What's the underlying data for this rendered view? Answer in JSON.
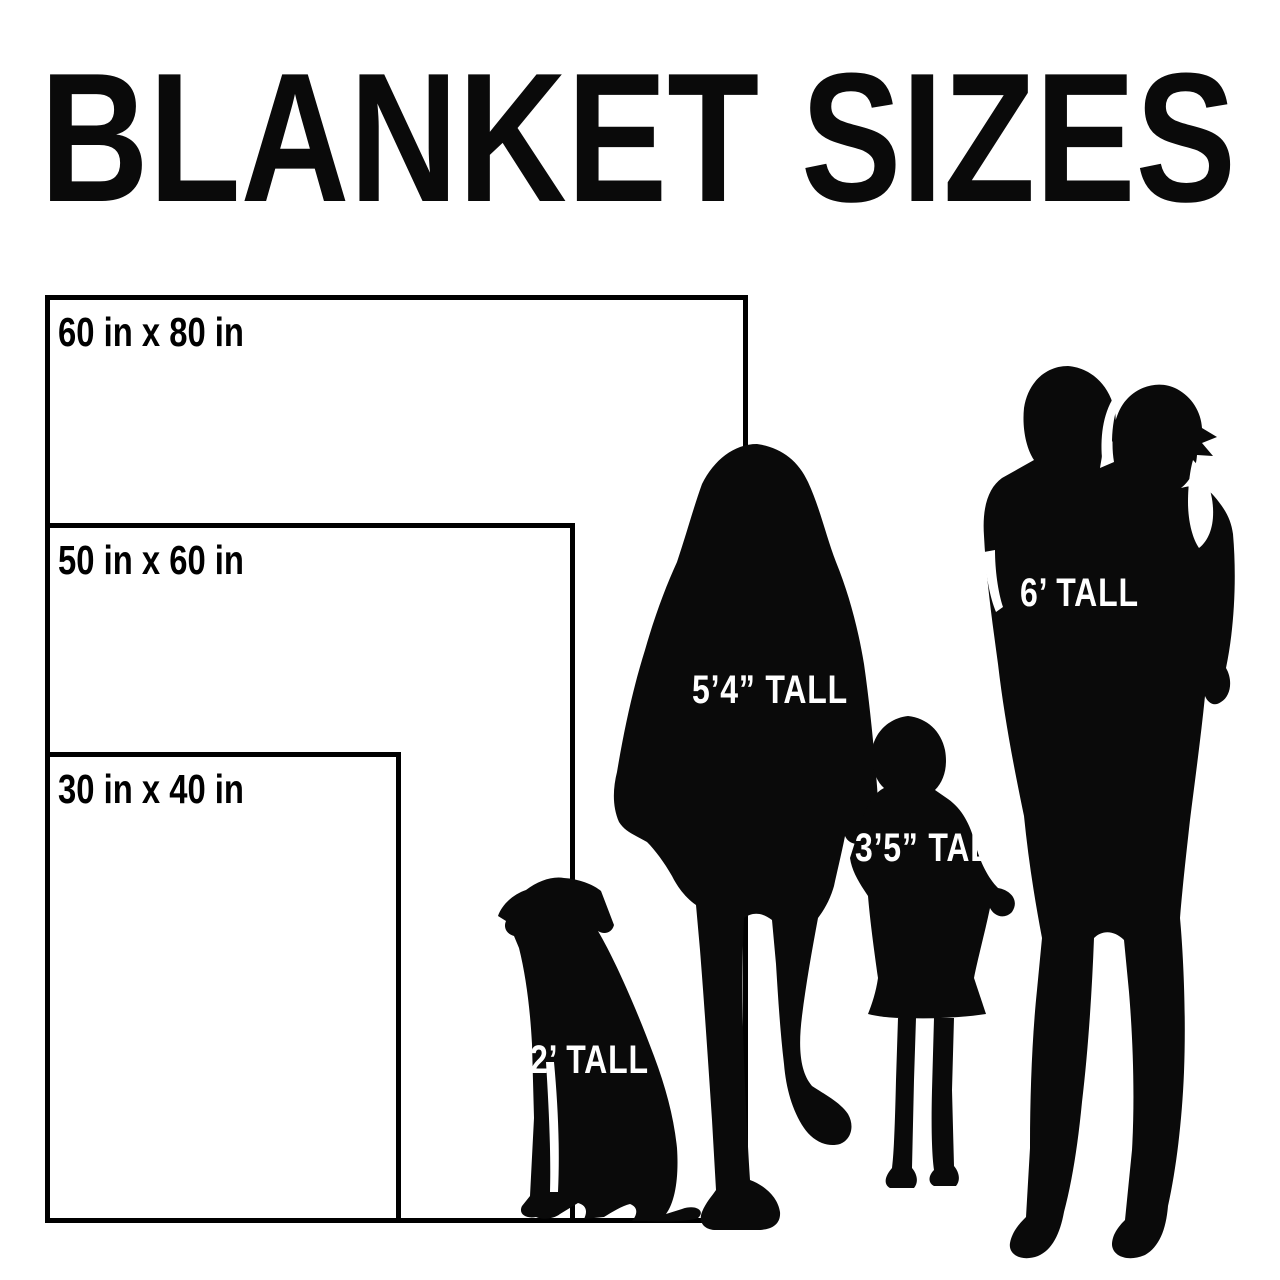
{
  "title": "BLANKET SIZES",
  "blankets": [
    {
      "name": "large",
      "label": "60 in x 80 in",
      "width_in": 60,
      "height_in": 80
    },
    {
      "name": "medium",
      "label": "50 in x 60 in",
      "width_in": 50,
      "height_in": 60
    },
    {
      "name": "small",
      "label": "30 in x 40 in",
      "width_in": 30,
      "height_in": 40
    }
  ],
  "figures": [
    {
      "name": "dog",
      "label": "2’ TALL"
    },
    {
      "name": "woman",
      "label": "5’4” TALL"
    },
    {
      "name": "child",
      "label": "3’5” TALL"
    },
    {
      "name": "man-carrying-toddler",
      "label": "6’ TALL"
    }
  ],
  "colors": {
    "background": "#ffffff",
    "silhouette": "#0a0a0a",
    "rect_border": "#000000",
    "label_on_dark": "#ffffff",
    "label_on_light": "#000000"
  }
}
